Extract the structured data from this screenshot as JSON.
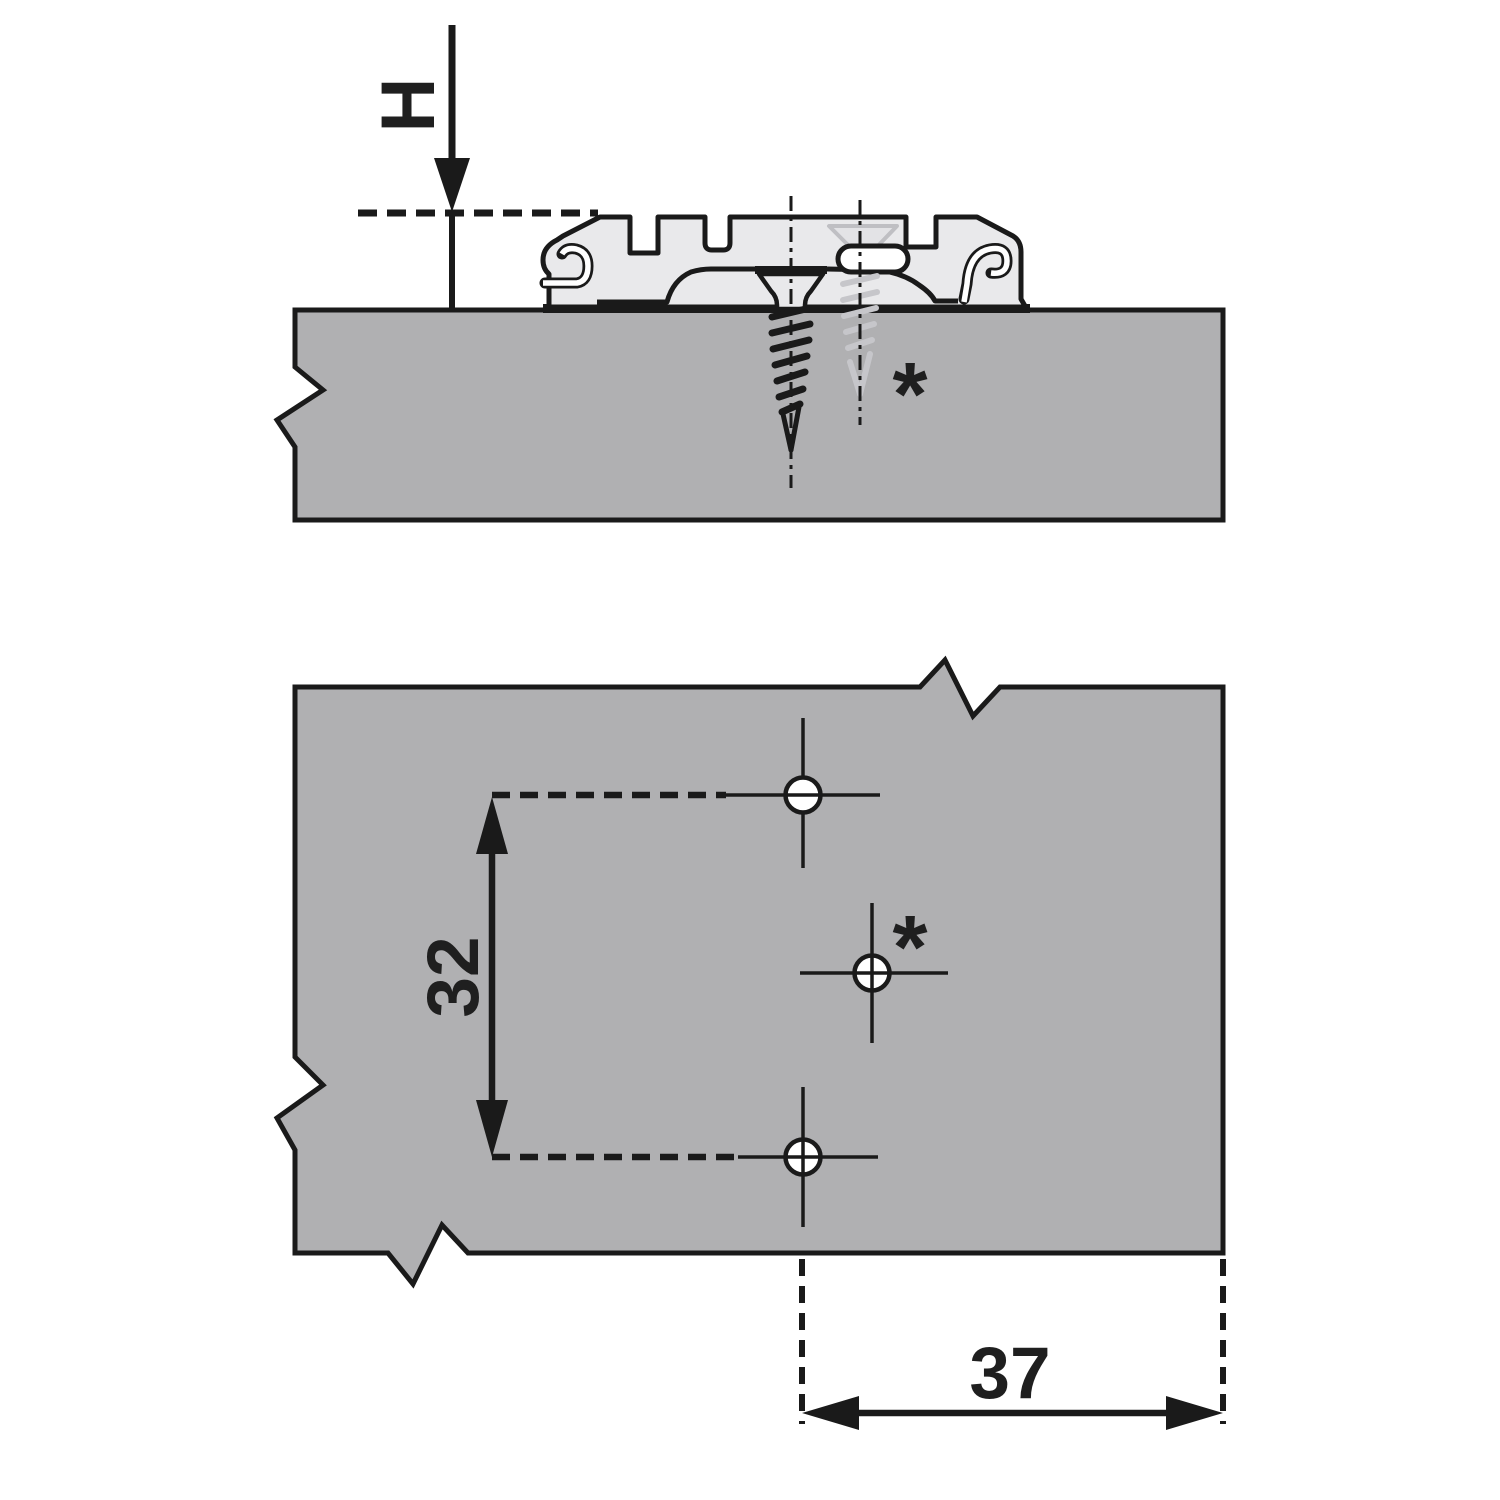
{
  "title": "Mounting plate drilling and installation diagram",
  "colors": {
    "background": "#ffffff",
    "panel_fill": "#b0b0b2",
    "plate_fill": "#e9e9eb",
    "outline": "#1a1a1a",
    "ghost_screw": "#c6c6ca"
  },
  "side_view": {
    "height_dimension": {
      "label": "H"
    },
    "annotation": {
      "symbol": "*"
    }
  },
  "plan_view": {
    "row_spacing_dimension": {
      "label": "32"
    },
    "edge_distance_dimension": {
      "label": "37"
    },
    "annotation": {
      "symbol": "*"
    }
  }
}
